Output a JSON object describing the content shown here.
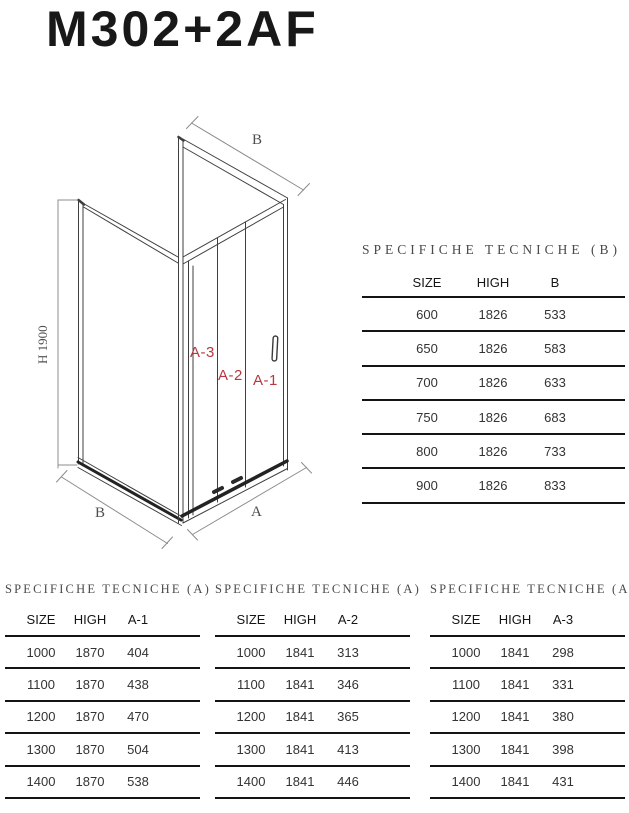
{
  "header": {
    "title": "M302+2AF"
  },
  "diagram": {
    "height_label": "H 1900",
    "b_top_label": "B",
    "b_bottom_label": "B",
    "a_bottom_label": "A",
    "door_labels": {
      "a1": "A-1",
      "a2": "A-2",
      "a3": "A-3"
    },
    "accent_color": "#b5383f",
    "line_color": "#3f3f3f"
  },
  "table_b": {
    "title": "SPECIFICHE TECNICHE (B)",
    "columns": [
      "SIZE",
      "HIGH",
      "B"
    ],
    "rows": [
      [
        "600",
        "1826",
        "533"
      ],
      [
        "650",
        "1826",
        "583"
      ],
      [
        "700",
        "1826",
        "633"
      ],
      [
        "750",
        "1826",
        "683"
      ],
      [
        "800",
        "1826",
        "733"
      ],
      [
        "900",
        "1826",
        "833"
      ]
    ]
  },
  "tables_a": [
    {
      "title": "SPECIFICHE TECNICHE (A)",
      "columns": [
        "SIZE",
        "HIGH",
        "A-1"
      ],
      "rows": [
        [
          "1000",
          "1870",
          "404"
        ],
        [
          "1100",
          "1870",
          "438"
        ],
        [
          "1200",
          "1870",
          "470"
        ],
        [
          "1300",
          "1870",
          "504"
        ],
        [
          "1400",
          "1870",
          "538"
        ]
      ]
    },
    {
      "title": "SPECIFICHE TECNICHE (A)",
      "columns": [
        "SIZE",
        "HIGH",
        "A-2"
      ],
      "rows": [
        [
          "1000",
          "1841",
          "313"
        ],
        [
          "1100",
          "1841",
          "346"
        ],
        [
          "1200",
          "1841",
          "365"
        ],
        [
          "1300",
          "1841",
          "413"
        ],
        [
          "1400",
          "1841",
          "446"
        ]
      ]
    },
    {
      "title": "SPECIFICHE TECNICHE (A)",
      "columns": [
        "SIZE",
        "HIGH",
        "A-3"
      ],
      "rows": [
        [
          "1000",
          "1841",
          "298"
        ],
        [
          "1100",
          "1841",
          "331"
        ],
        [
          "1200",
          "1841",
          "380"
        ],
        [
          "1300",
          "1841",
          "398"
        ],
        [
          "1400",
          "1841",
          "431"
        ]
      ]
    }
  ]
}
